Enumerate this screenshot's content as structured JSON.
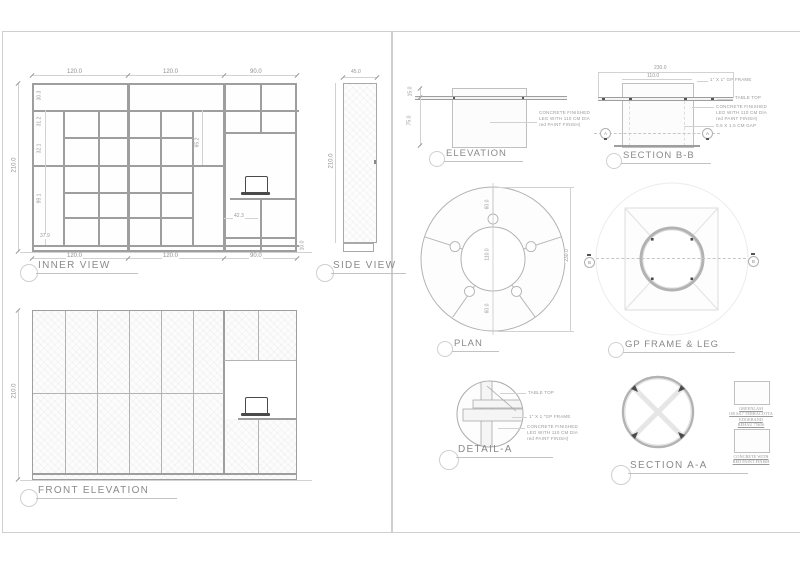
{
  "left": {
    "inner_view": {
      "label": "INNER VIEW",
      "dim_top": [
        "120.0",
        "120.0",
        "90.0"
      ],
      "dim_bottom": [
        "120.0",
        "120.0",
        "90.0"
      ],
      "dim_left": "210.0",
      "dim_plinth": "10.0",
      "dim_rows": [
        "30.3",
        "31.2",
        "32.1",
        "99.1",
        "37.9"
      ],
      "dim_mid": "65.2",
      "dim_niche": "42.3"
    },
    "side_view": {
      "label": "SIDE VIEW",
      "dim_top": "45.0",
      "dim_left": "210.0"
    },
    "front_elevation": {
      "label": "FRONT ELEVATION",
      "dim_left": "210.0"
    }
  },
  "right": {
    "elevation": {
      "label": "ELEVATION",
      "dim_thickness": "15.0",
      "dim_height": "75.0",
      "note": [
        "CONCRETE FINISHED",
        "LEG WITH 110 CM DIA",
        "red PAINT FINISH)"
      ]
    },
    "section_bb": {
      "label": "SECTION B-B",
      "dim_overall": "230.0",
      "dim_inner": "110.0",
      "marker": "A",
      "note_frame": "1\" X 1\" GP FRAME",
      "note_top": "TABLE TOP",
      "note_leg": [
        "CONCRETE FINISHED",
        "LEG WITH 110 CM DIA",
        "red PAINT FINISH)"
      ],
      "note_gap": "0.5 X 1.5 CM GAP"
    },
    "plan": {
      "label": "PLAN",
      "dim_outer": "230.0",
      "dim_inner": "110.0",
      "dim_seg_top": "60.0",
      "dim_seg_bottom": "60.0",
      "marker": "B"
    },
    "gp_frame": {
      "label": "GP FRAME & LEG",
      "marker": "B"
    },
    "detail_a": {
      "label": "DETAIL-A",
      "note_top": "TABLE TOP",
      "note_frame": "1\" X 1 \"GP FRAME",
      "note_leg": [
        "CONCRETE FINISHED",
        "LEG WITH 110 CM DIA",
        "red PAINT FINISH)"
      ]
    },
    "section_aa": {
      "label": "SECTION A-A"
    },
    "materials": {
      "m1": [
        "GREENLAM",
        "OR SA7 TERRACOTTA",
        "EDGEBAND",
        "REHAU 75656"
      ],
      "m2": [
        "CONCRETE  WITH",
        "RED PAINT FINISH"
      ]
    }
  }
}
